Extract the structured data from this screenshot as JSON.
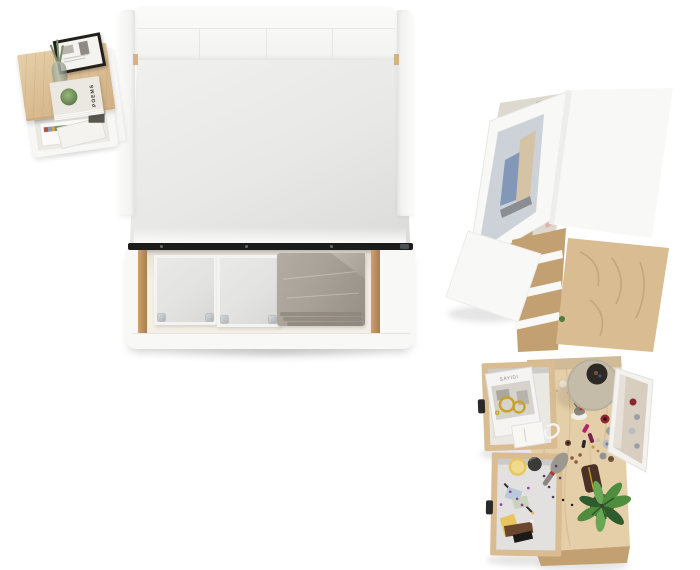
{
  "texts": {
    "book_title": "POEMS",
    "magazine_masthead": "SAYIDI"
  },
  "colors": {
    "bg": "#ffffff",
    "furniture-white": "#f8f8f6",
    "oak": "#d9bc92",
    "oak-light": "#e5cfa8",
    "oak-dark": "#c2a071",
    "mattress": "#e8e8e7",
    "bed-rail-dark": "#1c1c1b",
    "drawer-interior": "#f3efe7",
    "storage-box": "#e2e2e1",
    "blanket": "#a7a198",
    "denim": "#6f89ae",
    "denim-dark": "#53709b",
    "pink-cloth": "#e2b2a6",
    "wardrobe-mirror": "#ccd2d7",
    "lamp-shade": "#c4bba8",
    "lamp-hole": "#2c2823",
    "vanity-mirror": "#d7cec0",
    "leaf": "#4e8c3e",
    "leaf-dark": "#2f5c2c",
    "plant-pot": "#3e3c37",
    "gold": "#c9a227",
    "powder-box-yellow": "#e7c660",
    "perfume-red": "#8e2430",
    "perfume-gray": "#9aa0a6",
    "clutch-brown": "#4a3125",
    "lipstick-magenta": "#b1246a"
  },
  "items": {
    "bed": [
      "upholstered-headboard",
      "mattress",
      "open-storage-drawer",
      "storage-box",
      "storage-box",
      "folded-blanket"
    ],
    "nightstand": [
      "wood-top",
      "picture-frame",
      "glass-vase",
      "poetry-book",
      "open-shelf-with-magazines"
    ],
    "wardrobe": [
      "open-door-with-mirror",
      "shelves-with-folded-clothes",
      "white-top-panel"
    ],
    "chest": [
      "oak-top",
      "open-white-door",
      "drawer-fronts"
    ],
    "vanity": [
      "oak-desktop",
      "open-drawer-with-magazine-and-jewelry",
      "open-drawer-with-cosmetics",
      "table-lamp",
      "standing-mirror",
      "perfume-bottles",
      "hairbrush",
      "necklace",
      "lipsticks",
      "clutch-case",
      "potted-plant",
      "deer-figurine",
      "powder-jar"
    ]
  }
}
